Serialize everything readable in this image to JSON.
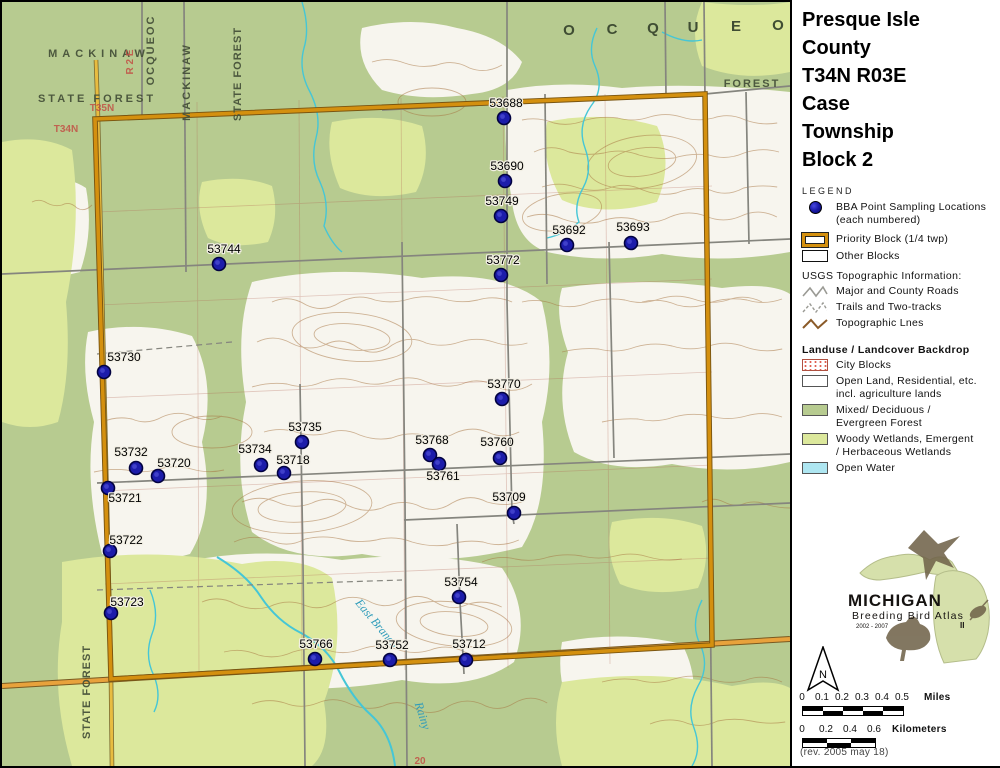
{
  "title": {
    "lines": [
      "Presque Isle",
      "County",
      "T34N R03E",
      "Case",
      "Township",
      "Block 2"
    ]
  },
  "legend": {
    "heading": "LEGEND",
    "bba_line1": "BBA Point Sampling Locations",
    "bba_line2": "(each numbered)",
    "priority_block": "Priority Block (1/4 twp)",
    "other_blocks": "Other Blocks",
    "usgs_heading": "USGS Topographic Information:",
    "usgs_items": [
      "Major and County Roads",
      "Trails and Two-tracks",
      "Topographic Lnes"
    ],
    "landuse_heading": "Landuse / Landcover Backdrop",
    "city_blocks": "City Blocks",
    "open_land_1": "Open Land, Residential, etc.",
    "open_land_2": "incl. agriculture lands",
    "mixed_1": "Mixed/ Deciduous /",
    "mixed_2": "Evergreen Forest",
    "woody_1": "Woody Wetlands, Emergent",
    "woody_2": "/ Herbaceous Wetlands",
    "open_water": "Open Water"
  },
  "logo": {
    "name": "MICHIGAN",
    "subtitle": "Breeding Bird Atlas",
    "years": "2002 - 2007",
    "numeral": "II"
  },
  "north_label": "N",
  "scale_miles": {
    "ticks": [
      "0",
      "0.1",
      "0.2",
      "0.3",
      "0.4",
      "0.5"
    ],
    "unit": "Miles"
  },
  "scale_km": {
    "ticks": [
      "0",
      "0.2",
      "0.4",
      "0.6"
    ],
    "unit": "Kilometers"
  },
  "revision": "(rev. 2005 may 18)",
  "colors": {
    "priority_block": "#d2890f",
    "point_fill": "#1c1caa",
    "forest_green": "#b7cb90",
    "wetland_green": "#dce89c",
    "open_water": "#aee6f1",
    "highway_orange": "#e8a23c"
  },
  "map": {
    "points": [
      {
        "id": "53688",
        "x": 502,
        "y": 116,
        "lx": 504,
        "ly": 105
      },
      {
        "id": "53690",
        "x": 503,
        "y": 179,
        "lx": 505,
        "ly": 168
      },
      {
        "id": "53749",
        "x": 499,
        "y": 214,
        "lx": 500,
        "ly": 203
      },
      {
        "id": "53692",
        "x": 565,
        "y": 243,
        "lx": 567,
        "ly": 232
      },
      {
        "id": "53693",
        "x": 629,
        "y": 241,
        "lx": 631,
        "ly": 229
      },
      {
        "id": "53744",
        "x": 217,
        "y": 262,
        "lx": 222,
        "ly": 251
      },
      {
        "id": "53772",
        "x": 499,
        "y": 273,
        "lx": 501,
        "ly": 262
      },
      {
        "id": "53730",
        "x": 102,
        "y": 370,
        "lx": 122,
        "ly": 359
      },
      {
        "id": "53770",
        "x": 500,
        "y": 397,
        "lx": 502,
        "ly": 386
      },
      {
        "id": "53735",
        "x": 300,
        "y": 440,
        "lx": 303,
        "ly": 429
      },
      {
        "id": "53768",
        "x": 428,
        "y": 453,
        "lx": 430,
        "ly": 442
      },
      {
        "id": "53760",
        "x": 498,
        "y": 456,
        "lx": 495,
        "ly": 444
      },
      {
        "id": "53732",
        "x": 134,
        "y": 466,
        "lx": 129,
        "ly": 454
      },
      {
        "id": "53720",
        "x": 156,
        "y": 474,
        "lx": 172,
        "ly": 465
      },
      {
        "id": "53734",
        "x": 259,
        "y": 463,
        "lx": 253,
        "ly": 451
      },
      {
        "id": "53718",
        "x": 282,
        "y": 471,
        "lx": 291,
        "ly": 462
      },
      {
        "id": "53761",
        "x": 437,
        "y": 462,
        "lx": 441,
        "ly": 478
      },
      {
        "id": "53709",
        "x": 512,
        "y": 511,
        "lx": 507,
        "ly": 499
      },
      {
        "id": "53721",
        "x": 106,
        "y": 486,
        "lx": 123,
        "ly": 500
      },
      {
        "id": "53722",
        "x": 108,
        "y": 549,
        "lx": 124,
        "ly": 542
      },
      {
        "id": "53723",
        "x": 109,
        "y": 611,
        "lx": 125,
        "ly": 604
      },
      {
        "id": "53754",
        "x": 457,
        "y": 595,
        "lx": 459,
        "ly": 584
      },
      {
        "id": "53766",
        "x": 313,
        "y": 657,
        "lx": 314,
        "ly": 646
      },
      {
        "id": "53752",
        "x": 388,
        "y": 658,
        "lx": 390,
        "ly": 647
      },
      {
        "id": "53712",
        "x": 464,
        "y": 658,
        "lx": 467,
        "ly": 646
      }
    ],
    "area_labels": [
      {
        "text": "MACKINAW",
        "x": 97,
        "y": 55,
        "cls": "forest",
        "ls": 5
      },
      {
        "text": "STATE FOREST",
        "x": 95,
        "y": 100,
        "cls": "forest",
        "ls": 3
      },
      {
        "text": "OCQUEOC",
        "x": 152,
        "y": 48,
        "rot": -90,
        "cls": "forest",
        "ls": 2
      },
      {
        "text": "MACKINAW",
        "x": 188,
        "y": 80,
        "rot": -90,
        "cls": "forest",
        "ls": 2
      },
      {
        "text": "STATE FOREST",
        "x": 239,
        "y": 72,
        "rot": -90,
        "cls": "forest",
        "ls": 1
      },
      {
        "text": "R 2 E",
        "x": 131,
        "y": 60,
        "rot": -90,
        "cls": "red"
      },
      {
        "text": "T35N",
        "x": 100,
        "y": 109,
        "cls": "red"
      },
      {
        "text": "T34N",
        "x": 64,
        "y": 130,
        "cls": "red"
      },
      {
        "text": "O",
        "x": 567,
        "y": 33,
        "cls": "forest-big"
      },
      {
        "text": "C",
        "x": 610,
        "y": 32,
        "cls": "forest-big"
      },
      {
        "text": "Q",
        "x": 651,
        "y": 31,
        "cls": "forest-big"
      },
      {
        "text": "U",
        "x": 691,
        "y": 30,
        "cls": "forest-big"
      },
      {
        "text": "E",
        "x": 734,
        "y": 29,
        "cls": "forest-big"
      },
      {
        "text": "O",
        "x": 776,
        "y": 28,
        "cls": "forest-big"
      },
      {
        "text": "FOREST",
        "x": 750,
        "y": 85,
        "cls": "forest",
        "ls": 2
      },
      {
        "text": "STATE FOREST",
        "x": 88,
        "y": 690,
        "rot": -90,
        "cls": "forest",
        "ls": 1
      },
      {
        "text": "East Branch",
        "x": 372,
        "y": 624,
        "rot": 50,
        "cls": "water"
      },
      {
        "text": "Rainy",
        "x": 417,
        "y": 715,
        "rot": 72,
        "cls": "water"
      },
      {
        "text": "20",
        "x": 418,
        "y": 762,
        "cls": "red"
      }
    ]
  }
}
